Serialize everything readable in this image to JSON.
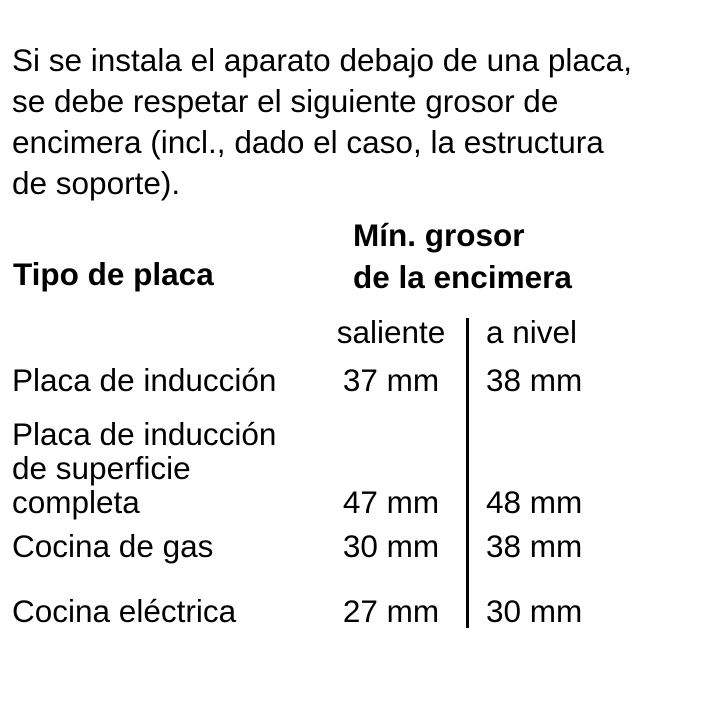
{
  "intro": {
    "text": "Si se instala el aparato debajo de una placa,\nse debe respetar el siguiente grosor de\nencimera (incl., dado el caso, la estructura\nde soporte)."
  },
  "table": {
    "col_type_header": "Tipo de placa",
    "col_thickness_header": "Mín. grosor\nde la encimera",
    "subcol_proud": "saliente",
    "subcol_flush": "a nivel",
    "rows": [
      {
        "label": "Placa de inducción",
        "saliente": "37 mm",
        "a_nivel": "38 mm"
      },
      {
        "label": "Placa de inducción\nde superficie\ncompleta",
        "saliente": "47 mm",
        "a_nivel": "48 mm"
      },
      {
        "label": "Cocina de gas",
        "saliente": "30 mm",
        "a_nivel": "38 mm"
      },
      {
        "label": "Cocina eléctrica",
        "saliente": "27 mm",
        "a_nivel": "30 mm"
      }
    ]
  },
  "colors": {
    "text": "#000000",
    "background": "#ffffff",
    "divider": "#000000"
  }
}
